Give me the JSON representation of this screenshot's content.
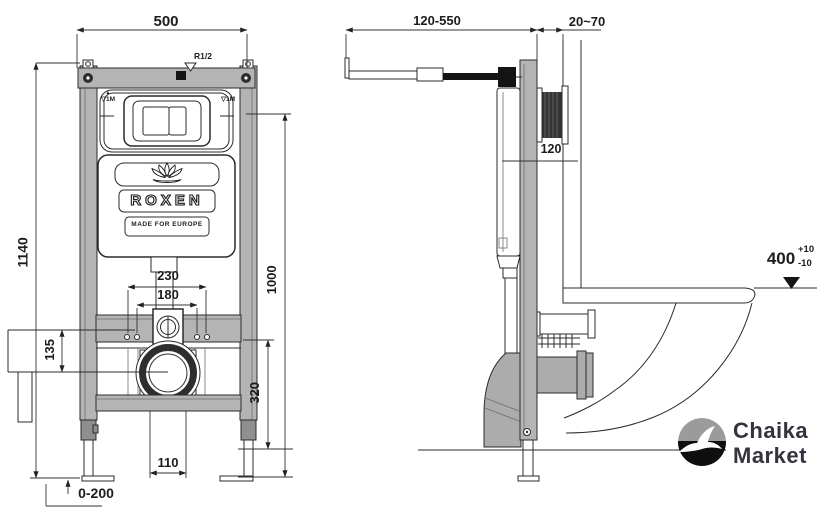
{
  "front_view": {
    "dimensions": {
      "overall_width": "500",
      "overall_height": "1140",
      "fixing_spacing_outer": "230",
      "fixing_spacing_inner": "180",
      "side_bracket": "135",
      "plate_height": "1000",
      "outlet_center_height": "320",
      "outlet_offset": "110",
      "leg_adjustment": "0-200"
    },
    "labels": {
      "water_inlet": "R1/2",
      "level_arrow": "▲",
      "level_mark_left": "▽1M",
      "level_mark_right": "▽1M"
    },
    "cistern": {
      "brand": "ROXEN",
      "tagline": "MADE FOR EUROPE"
    }
  },
  "side_view": {
    "dimensions": {
      "depth_adjustment": "120-550",
      "wall_finish": "20~70",
      "shaft_length": "120",
      "bowl_height": "400",
      "bowl_height_plus": "+10",
      "bowl_height_minus": "-10"
    }
  },
  "branding": {
    "line1": "Chaika",
    "line2": "Market"
  },
  "colors": {
    "line": "#2b2b2b",
    "frame_gray": "#b4b4b4",
    "pipe_gray": "#acacac",
    "black": "#141414",
    "logo_top_gray": "#9b9b9b",
    "logo_bottom_black": "#0f0f0f"
  }
}
